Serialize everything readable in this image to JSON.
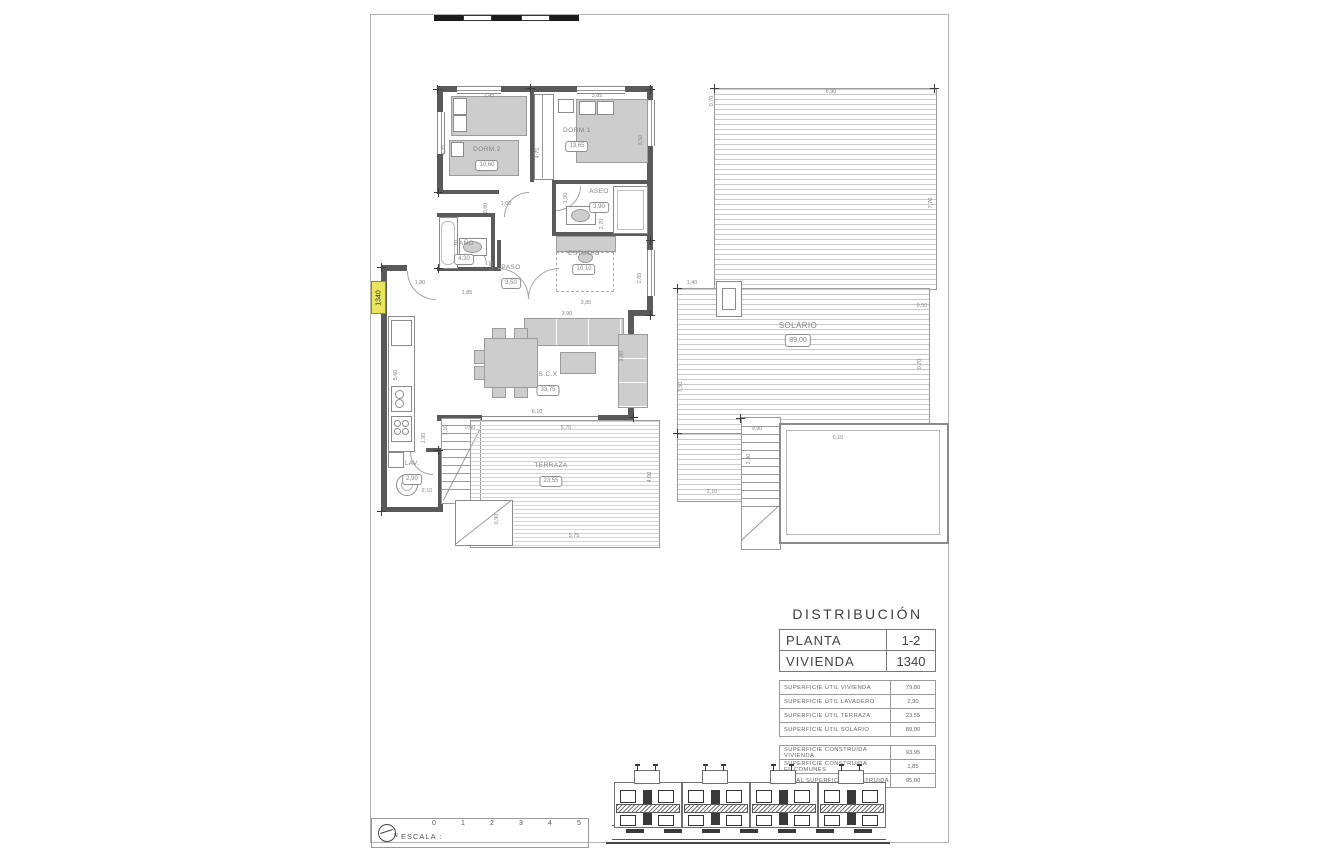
{
  "plan": {
    "unit_tag": "1340",
    "rooms": [
      {
        "name": "DORM.2",
        "area": "10,60",
        "x": 487,
        "y": 146
      },
      {
        "name": "DORM.1",
        "area": "13,65",
        "x": 577,
        "y": 127
      },
      {
        "name": "ASEO",
        "area": "3,90",
        "x": 599,
        "y": 188
      },
      {
        "name": "BAÑO",
        "area": "4,30",
        "x": 464,
        "y": 240
      },
      {
        "name": "PASO",
        "area": "3,50",
        "x": 511,
        "y": 264
      },
      {
        "name": "ESTUDIO",
        "area": "10,10",
        "x": 584,
        "y": 250
      },
      {
        "name": "S.C.X",
        "area": "33,75",
        "x": 548,
        "y": 371
      },
      {
        "name": "LAV.",
        "area": "2,90",
        "x": 412,
        "y": 460
      },
      {
        "name": "TERRAZA",
        "area": "23,55",
        "x": 551,
        "y": 462
      },
      {
        "name": "SOLARIO",
        "area": "89,00",
        "x": 798,
        "y": 322,
        "lg": true
      }
    ],
    "dims": [
      {
        "t": "2,45",
        "x": 489,
        "y": 96
      },
      {
        "t": "3,85",
        "x": 597,
        "y": 96
      },
      {
        "t": "4,35",
        "x": 444,
        "y": 150,
        "v": 1
      },
      {
        "t": "4,75",
        "x": 538,
        "y": 153,
        "v": 1
      },
      {
        "t": "3,50",
        "x": 641,
        "y": 140,
        "v": 1
      },
      {
        "t": "1,00",
        "x": 506,
        "y": 204
      },
      {
        "t": "0,60",
        "x": 486,
        "y": 208,
        "v": 1
      },
      {
        "t": "1,50",
        "x": 566,
        "y": 198,
        "v": 1
      },
      {
        "t": "2,70",
        "x": 602,
        "y": 224,
        "v": 1
      },
      {
        "t": "2,80",
        "x": 492,
        "y": 266,
        "v": 1
      },
      {
        "t": "1,85",
        "x": 467,
        "y": 293
      },
      {
        "t": "1,80",
        "x": 420,
        "y": 283
      },
      {
        "t": "2,65",
        "x": 640,
        "y": 278,
        "v": 1
      },
      {
        "t": "3,85",
        "x": 586,
        "y": 303
      },
      {
        "t": "3,90",
        "x": 567,
        "y": 314
      },
      {
        "t": "3,80",
        "x": 622,
        "y": 356,
        "v": 1
      },
      {
        "t": "5,60",
        "x": 396,
        "y": 375,
        "v": 1
      },
      {
        "t": "6,10",
        "x": 537,
        "y": 412
      },
      {
        "t": "5,70",
        "x": 566,
        "y": 428
      },
      {
        "t": "0,90",
        "x": 470,
        "y": 428
      },
      {
        "t": "1,10",
        "x": 446,
        "y": 430,
        "v": 1
      },
      {
        "t": "1,95",
        "x": 424,
        "y": 438,
        "v": 1
      },
      {
        "t": "2,10",
        "x": 427,
        "y": 491
      },
      {
        "t": "4,00",
        "x": 650,
        "y": 477,
        "v": 1
      },
      {
        "t": "5,75",
        "x": 574,
        "y": 536
      },
      {
        "t": "0,90",
        "x": 497,
        "y": 519,
        "v": 1
      },
      {
        "t": "6,90",
        "x": 831,
        "y": 92
      },
      {
        "t": "0,70",
        "x": 712,
        "y": 101,
        "v": 1
      },
      {
        "t": "7,70",
        "x": 931,
        "y": 203,
        "v": 1
      },
      {
        "t": "1,40",
        "x": 692,
        "y": 283
      },
      {
        "t": "0,50",
        "x": 922,
        "y": 306
      },
      {
        "t": "7,50",
        "x": 681,
        "y": 387,
        "v": 1
      },
      {
        "t": "0,70",
        "x": 920,
        "y": 364,
        "v": 1
      },
      {
        "t": "6,10",
        "x": 838,
        "y": 438
      },
      {
        "t": "0,90",
        "x": 757,
        "y": 429
      },
      {
        "t": "2,30",
        "x": 749,
        "y": 459,
        "v": 1
      },
      {
        "t": "2,10",
        "x": 712,
        "y": 492
      }
    ]
  },
  "distribution": {
    "title": "DISTRIBUCIÓN",
    "main_rows": [
      {
        "label": "PLANTA",
        "value": "1-2"
      },
      {
        "label": "VIVIENDA",
        "value": "1340"
      }
    ],
    "useful_rows": [
      {
        "label": "SUPERFICIE ÚTIL VIVIENDA",
        "value": "79,80"
      },
      {
        "label": "SUPERFICIE ÚTIL LAVADERO",
        "value": "2,90"
      },
      {
        "label": "SUPERFICIE ÚTIL TERRAZA",
        "value": "23,55"
      },
      {
        "label": "SUPERFICIE ÚTIL SOLARIO",
        "value": "89,00"
      }
    ],
    "built_rows": [
      {
        "label": "SUPERFICIE CONSTRUIDA VIVIENDA",
        "value": "93,95"
      },
      {
        "label": "SUPERFICIE CONSTRUIDA EL.COMUNES",
        "value": "1,85"
      },
      {
        "label": "TOTAL SUPERFICIE CONSTRUIDA",
        "value": "95,80"
      }
    ]
  },
  "scalebar": {
    "label": "ESCALA :",
    "ticks": [
      "0",
      "1",
      "2",
      "3",
      "4",
      "5"
    ],
    "north_label": "N"
  },
  "colors": {
    "wall": "#5a5a5a",
    "highlight_yellow": "#e9e35c",
    "hatch_line": "#c9c9c9"
  }
}
